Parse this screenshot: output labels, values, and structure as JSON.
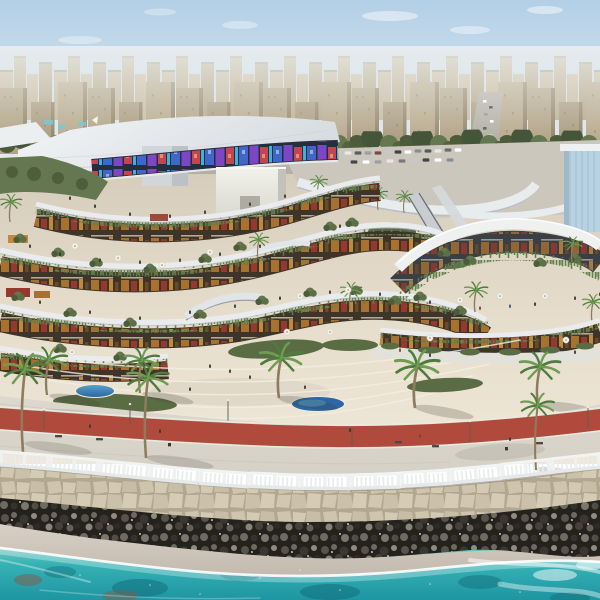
{
  "scene": {
    "type": "architectural-rendering",
    "description": "Aerial rendering of a curved terraced seafront shopping and dining complex: a dense beige city skyline and tree-lined highway behind, a white curved roof canopy with a colorful LED media facade, cascading white terraces with warm storefronts and hanging gardens, a round glass cafe pavilion, palm-dotted stepped plaza with blue water features, a red jogging track on a stone promenade, white classical balustrade, beige seawall, black breakwater rocks and turquoise sea with surf in the foreground",
    "elements": [
      "sky",
      "clouds",
      "city-skyline",
      "tree-line",
      "highway",
      "parking-lot",
      "roof-canopy",
      "led-media-facade",
      "service-core-cube",
      "terrace-levels",
      "storefronts",
      "hanging-gardens",
      "glass-pavilion",
      "escalators",
      "footbridges",
      "palm-trees",
      "plaza-steps",
      "planting-beds",
      "water-features",
      "red-jogging-track",
      "promenade",
      "lamp-posts",
      "benches",
      "white-balustrade",
      "stone-seawall",
      "breakwater-rocks",
      "beach-sand",
      "sea",
      "surf-foam"
    ]
  },
  "palette": {
    "sky-top": "#b3cfe6",
    "sky-mid": "#d3e2ee",
    "sky-horizon": "#eaece8",
    "city-far": "#c6b99f",
    "city-near": "#b3a487",
    "city-shadow": "#948569",
    "haze": "#eff1ee",
    "tree-dark": "#4c5c3a",
    "tree-mid": "#657750",
    "road": "#b3afa6",
    "parking": "#cbc7bd",
    "roof-light": "#f3f5f6",
    "roof-shade": "#d7dce1",
    "core-gray": "#bcc1c6",
    "led-dark": "#262d3c",
    "led-blue": "#3f66c8",
    "led-purple": "#7c46c4",
    "led-red": "#c44452",
    "led-cyan": "#3fb2d8",
    "store-base": "#3e342a",
    "store-amber": "#a8712f",
    "store-amber2": "#c08a3c",
    "store-red": "#96382e",
    "terrace-white": "#e9ebec",
    "terrace-shadow": "#b2b8be",
    "vine-green": "#5d7c48",
    "plaza-pave": "#e6ddcc",
    "pave-line": "#f4efe2",
    "shrub": "#5a6c44",
    "pool-light": "#58a0c8",
    "pool-deep": "#2d66a6",
    "track-red": "#b04a3c",
    "track-edge": "#eceadf",
    "prom-pave": "#d5d1c7",
    "balustrade": "#eff1f1",
    "wall-stone": "#cfc5ae",
    "wall-joint": "#b2a890",
    "rock-dark": "#24221d",
    "rock-mid": "#57524a",
    "rock-light": "#918b80",
    "sand": "#d9d1c7",
    "sand-wet": "#c3b9ae",
    "foam": "#ffffff",
    "sea-shallow": "#93d8d0",
    "sea-mid": "#36b2b4",
    "sea-deep": "#1e95a3",
    "sea-dark": "#0f6a76",
    "sea-red-reef": "#8a5848",
    "palm-trunk": "#8d7c5e",
    "palm-green": "#4e7c3e",
    "palm-light": "#6f9c50",
    "people-dark": "#3a352e"
  }
}
